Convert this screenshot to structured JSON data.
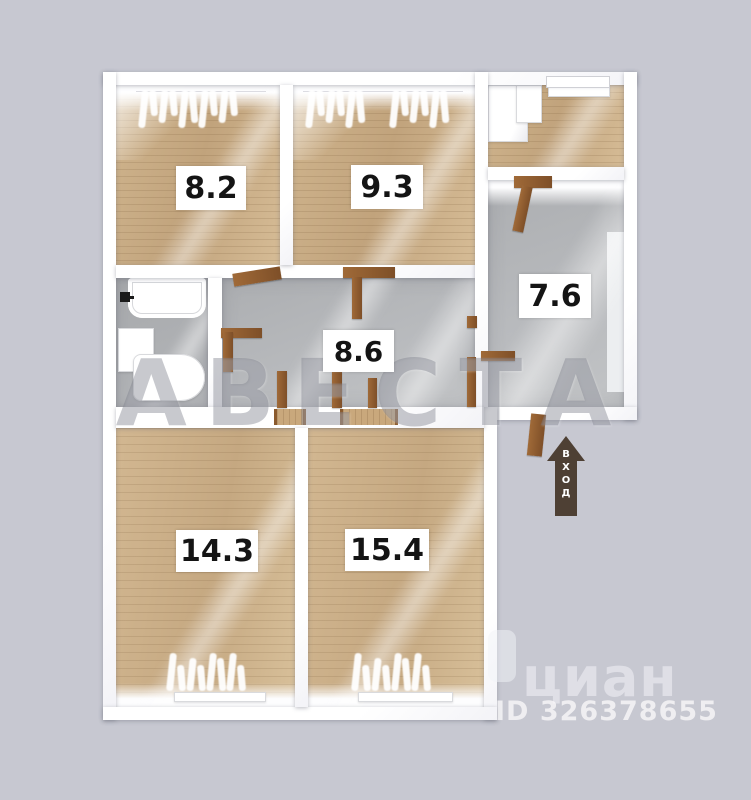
{
  "image_type": "apartment floor plan",
  "rooms": [
    {
      "name": "room-top-left",
      "label": "8.2"
    },
    {
      "name": "room-top-middle",
      "label": "9.3"
    },
    {
      "name": "room-right",
      "label": "7.6"
    },
    {
      "name": "hallway",
      "label": "8.6"
    },
    {
      "name": "room-bottom-left",
      "label": "14.3"
    },
    {
      "name": "room-bottom-right",
      "label": "15.4"
    }
  ],
  "entrance": {
    "label": "ВХОД"
  },
  "watermarks": {
    "agency": "АВЕСТА",
    "portal": "циан",
    "listing_id": "ID 326378655"
  },
  "icons": {
    "entrance_arrow": "up-arrow",
    "faucet": "black faucet glyph",
    "portal_pin": "rounded map-pin"
  },
  "colors": {
    "background": "#c7c8d1",
    "walls": "#ffffff",
    "wood_floor": "#c9ad85",
    "gray_floor": "#b2b4b6",
    "door_wood": "#8f5c2e",
    "entrance_arrow": "#4e4034",
    "label_bg": "#ffffff",
    "label_text": "#141414"
  }
}
